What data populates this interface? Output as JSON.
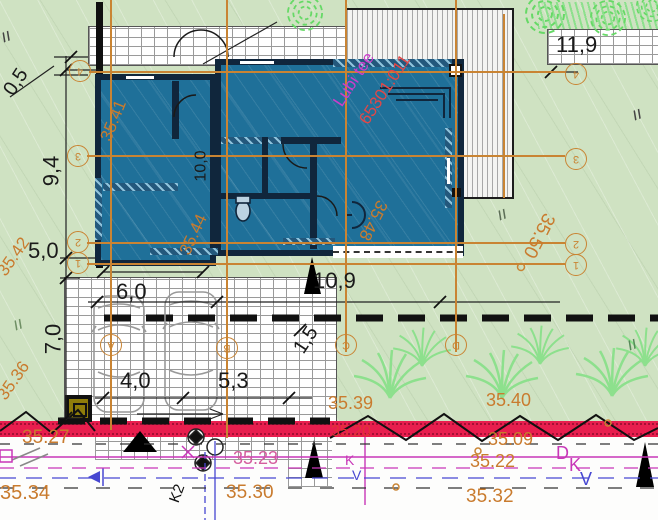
{
  "site": {
    "street_name": "Lubi tee",
    "cadastral_no": "65301:011"
  },
  "dims": {
    "d05": "0,5",
    "d94": "9,4",
    "d50": "5,0",
    "d70": "7,0",
    "d60": "6,0",
    "d40": "4,0",
    "d53": "5,3",
    "d109": "10,9",
    "d15": "1,5",
    "d119": "11,9",
    "d100": "10,0"
  },
  "elevations": {
    "e3541": "35.41",
    "e3542": "35.42",
    "e3536": "35.36",
    "e3544": "35.44",
    "e3548": "35.48",
    "e3550": "35.50",
    "e3539": "35.39",
    "e3540": "35.40",
    "e3527": "35.27",
    "e3534": "35.34",
    "e3509": "35.09",
    "e3522": "35.22",
    "e3532": "35.32",
    "e3530": "35.30",
    "e3523": "35.23",
    "e3520": "35.20"
  },
  "axes": {
    "h": {
      "a4": "4",
      "a3": "3",
      "a2": "2",
      "a1": "1"
    },
    "v": {
      "va": "A",
      "vb": "B",
      "vc": "C",
      "vd": "D"
    }
  },
  "utilities": {
    "k2": "K2",
    "k_small": "K",
    "v_small": "V",
    "d_big": "D",
    "k_big": "K",
    "v_big": "V"
  },
  "marks": {
    "slash": "//"
  },
  "colors": {
    "site_green": "#cfe2c2",
    "building_fill": "#1f7099",
    "wall_dark": "#10263c",
    "annotation_orange": "#c98433",
    "elevation_orange": "#c97b2e",
    "red_band": "#e81e4e",
    "magenta_utility": "#c837b8",
    "blue_utility": "#4747d1",
    "cadastral_red": "#e04848",
    "street_magenta": "#cb3ecb",
    "paving_joint": "#9a9a9a",
    "plant_green": "#8de08d",
    "tree_green": "#66d966"
  }
}
